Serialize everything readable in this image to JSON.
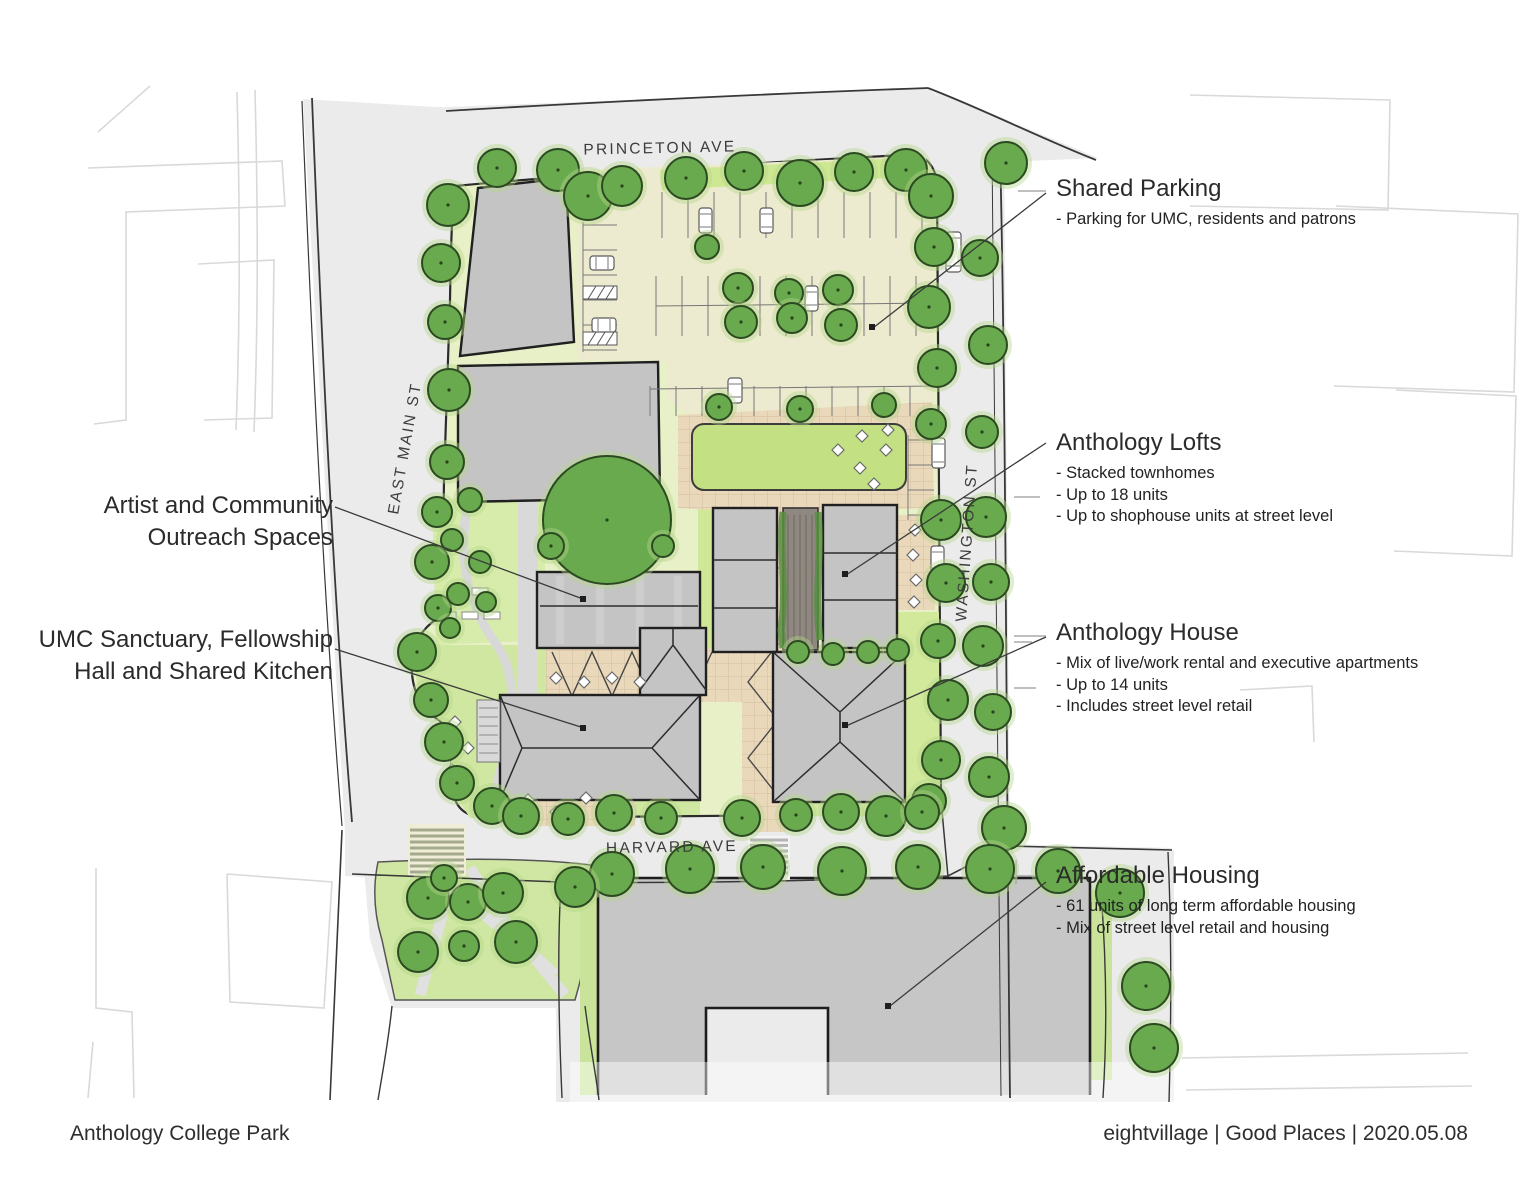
{
  "meta": {
    "title": "Anthology College Park",
    "credit": "eightvillage | Good Places | 2020.05.08"
  },
  "streets": {
    "north": "PRINCETON AVE",
    "west": "EAST MAIN ST",
    "east": "WASHINGTON ST",
    "south": "HARVARD AVE"
  },
  "labels": {
    "artist": {
      "line1": "Artist and Community",
      "line2": "Outreach Spaces"
    },
    "umc": {
      "line1": "UMC Sanctuary, Fellowship",
      "line2": "Hall and Shared Kitchen"
    }
  },
  "annotations": {
    "shared_parking": {
      "title": "Shared Parking",
      "bullets": [
        "- Parking for UMC, residents and patrons"
      ]
    },
    "anthology_lofts": {
      "title": "Anthology Lofts",
      "bullets": [
        "- Stacked townhomes",
        "- Up to 18 units",
        "- Up to shophouse units at street level"
      ]
    },
    "anthology_house": {
      "title": "Anthology House",
      "bullets": [
        "- Mix of live/work rental and executive apartments",
        "- Up to 14 units",
        "- Includes street level retail"
      ]
    },
    "affordable_housing": {
      "title": "Affordable Housing",
      "bullets": [
        "- 61 units of long term affordable housing",
        "- Mix of street level retail and housing"
      ]
    }
  },
  "colors": {
    "tree_green": "#69aa4e",
    "lawn_green": "#c3e183",
    "site_base": "#e7f0c6",
    "parking_cream": "#edebcf",
    "building_gray": "#c4c4c4",
    "path_tan": "#ead8bb",
    "street_gray": "#ebebeb",
    "ink": "#2b2b2b"
  }
}
